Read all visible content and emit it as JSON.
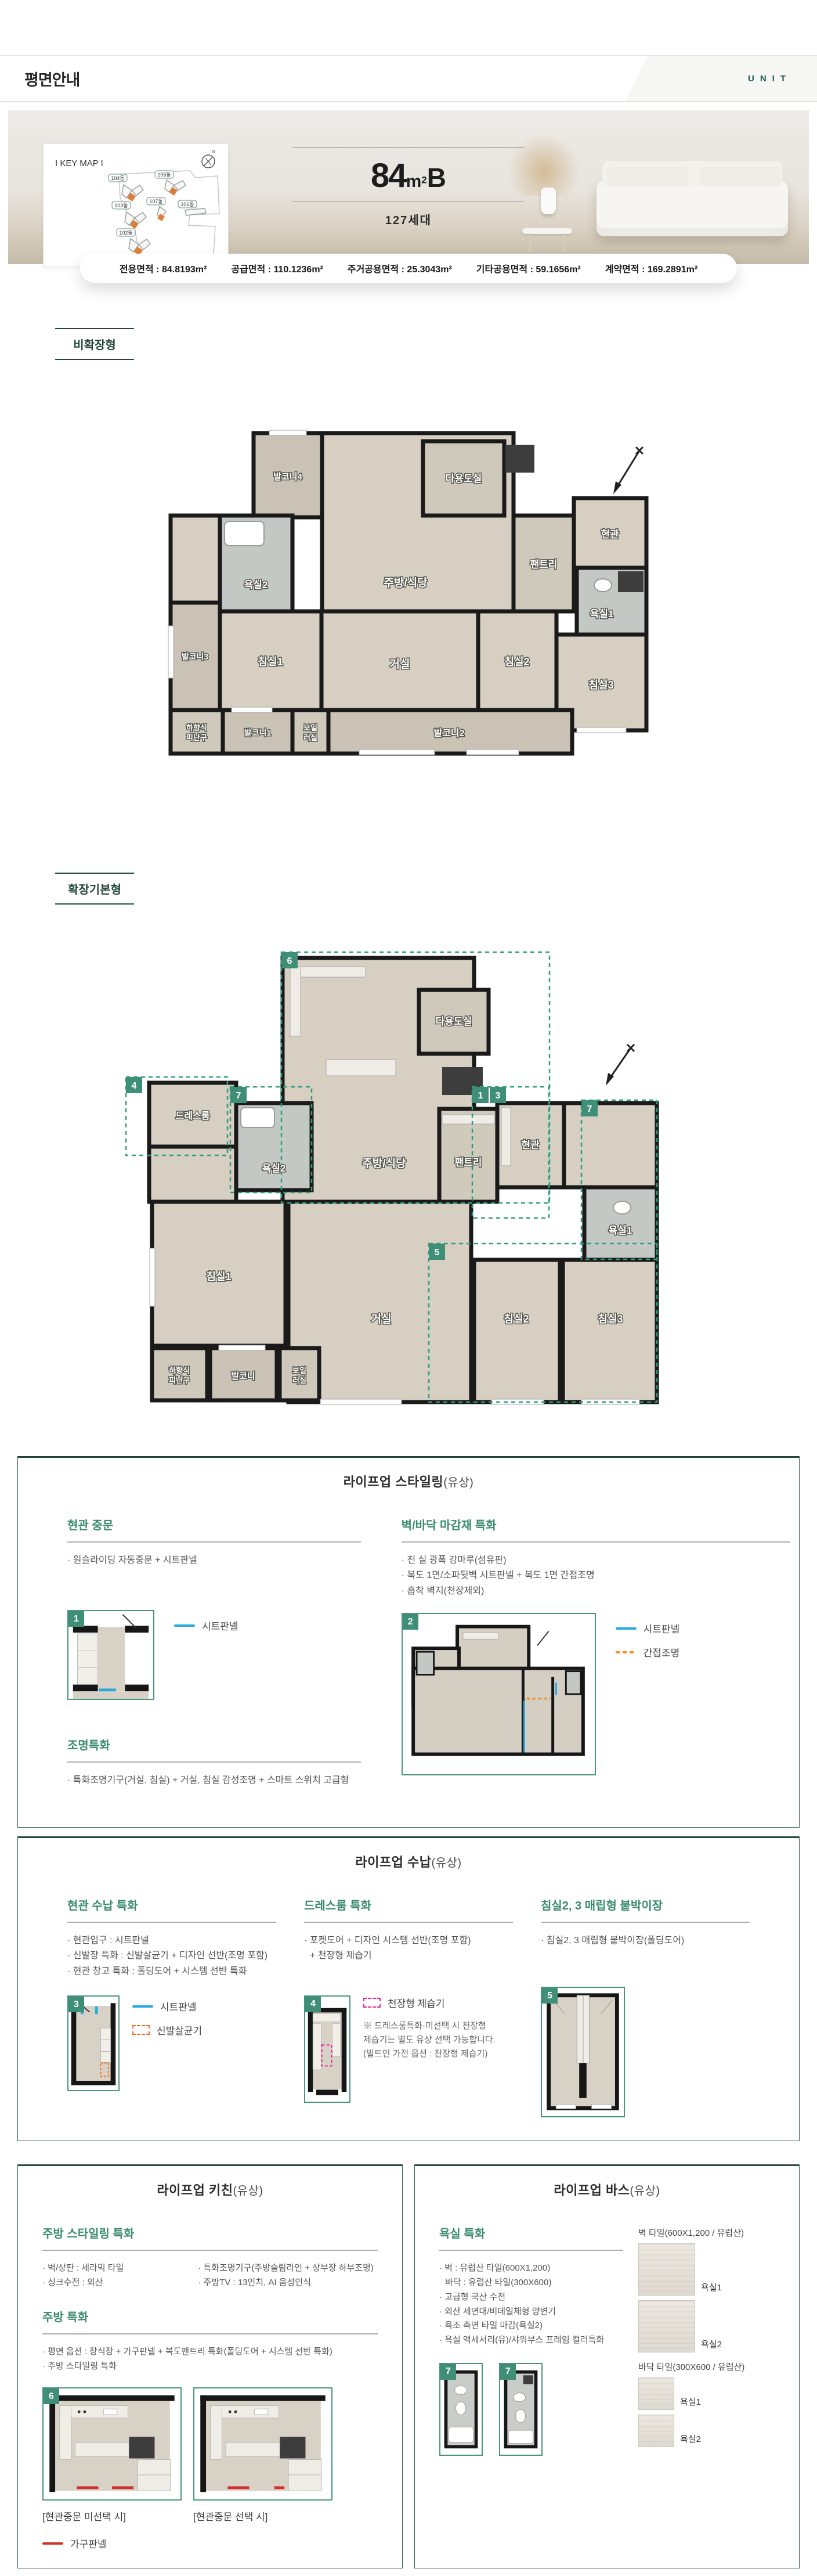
{
  "colors": {
    "accent_green": "#3a8a71",
    "dark_green": "#25473d",
    "teal": "#17574c",
    "legend_blue": "#2aa9e0",
    "legend_orange": "#ed6b21",
    "legend_indirect_orange": "#f0932c",
    "legend_magenta": "#ec1f8e",
    "legend_red": "#d0312d",
    "keymap_highlight_orange": "#dd7f3c"
  },
  "header": {
    "title": "평면안내",
    "unit": "UNIT"
  },
  "hero": {
    "keymap_title": "I KEY MAP I",
    "north": "N",
    "buildings": [
      "104동",
      "105동",
      "103동",
      "107동",
      "106동",
      "102동",
      "101동"
    ],
    "area_num": "84",
    "area_unit_m": "m",
    "area_unit_sup": "2",
    "area_type": "B",
    "households": "127세대"
  },
  "area_bar": [
    {
      "label": "전용면적 :",
      "value": "84.8193m²"
    },
    {
      "label": "공급면적 :",
      "value": "110.1236m²"
    },
    {
      "label": "주거공용면적 :",
      "value": "25.3043m²"
    },
    {
      "label": "기타공용면적 :",
      "value": "59.1656m²"
    },
    {
      "label": "계약면적 :",
      "value": "169.2891m²"
    }
  ],
  "plan1": {
    "tag": "비확장형",
    "rooms": {
      "balcony4": "발코니4",
      "utility": "다용도실",
      "kitchen": "주방/식당",
      "pantry": "팬트리",
      "entrance": "현관",
      "bath2": "욕실2",
      "bath1": "욕실1",
      "balcony3": "발코니3",
      "bed1": "침실1",
      "living": "거실",
      "bed2": "침실2",
      "bed3": "침실3",
      "escape1": "하향식",
      "escape2": "피난구",
      "balcony1": "발코니1",
      "boiler1": "보일",
      "boiler2": "러실",
      "balcony2": "발코니2"
    }
  },
  "plan2": {
    "tag": "확장기본형",
    "rooms": {
      "utility": "다용도실",
      "kitchen": "주방/식당",
      "pantry": "팬트리",
      "entrance": "현관",
      "dress": "드레스룸",
      "bath2": "욕실2",
      "bath1": "욕실1",
      "bed1": "침실1",
      "living": "거실",
      "bed2": "침실2",
      "bed3": "침실3",
      "escape1": "하향식",
      "escape2": "피난구",
      "balcony": "발코니",
      "boiler1": "보일",
      "boiler2": "러실"
    },
    "badges": {
      "b6": "6",
      "b4": "4",
      "b7l": "7",
      "b1": "1",
      "b3": "3",
      "b7r": "7",
      "b5": "5"
    }
  },
  "styling": {
    "title": "라이프업 스타일링",
    "fee": "(유상)",
    "door_h": "현관 중문",
    "door_b": "· 원슬라이딩 자동중문 + 시트판넬",
    "door_badge": "1",
    "door_legend": "시트판넬",
    "light_h": "조명특화",
    "light_b": "· 특화조명기구(거실, 침실) + 거실, 침실 감성조명 + 스마트 스위치 고급형",
    "wall_h": "벽/바닥 마감재 특화",
    "wall_b1": "· 전 실 광폭 강마루(섬유판)",
    "wall_b2": "· 복도 1면/소파뒷벽 시트판넬 + 복도 1면 간접조명",
    "wall_b3": "· 흡착 벽지(천장제외)",
    "wall_badge": "2",
    "wall_legend1": "시트판넬",
    "wall_legend2": "간접조명"
  },
  "storage": {
    "title": "라이프업 수납",
    "fee": "(유상)",
    "c1_h": "현관 수납 특화",
    "c1_b1": "· 현관입구 : 시트판넬",
    "c1_b2": "· 신발장 특화 : 신발살균기 + 디자인 선반(조명 포함)",
    "c1_b3": "· 현관 창고 특화 : 폴딩도어 + 시스템 선반 특화",
    "c1_badge": "3",
    "c1_leg1": "시트판넬",
    "c1_leg2": "신발살균기",
    "c2_h": "드레스룸 특화",
    "c2_b1": "· 포켓도어 + 디자인 시스템 선반(조명 포함)",
    "c2_b2": "+ 천장형 제습기",
    "c2_badge": "4",
    "c2_leg": "천장형 제습기",
    "c2_n1": "※ 드레스룸특화·미선택 시 천장형",
    "c2_n2": "제습기는 별도 유상 선택 가능합니다.",
    "c2_n3": "(빌트인 가전 옵션 : 천장형 제습기)",
    "c3_h": "침실2, 3 매립형 붙박이장",
    "c3_b1": "· 침실2, 3 매립형 붙박이장(폴딩도어)",
    "c3_badge": "5"
  },
  "kitchen": {
    "title": "라이프업 키친",
    "fee": "(유상)",
    "h1": "주방 스타일링 특화",
    "b1a1": "· 벽/상판 : 세라믹 타일",
    "b1a2": "· 싱크수전 : 외산",
    "b1b1": "· 특화조명기구(주방슬림라인 + 상부장 하부조명)",
    "b1b2": "· 주방TV : 13인치, AI 음성인식",
    "h2": "주방 특화",
    "b2a": "· 평면 옵션 : 장식장 + 가구판넬 + 복도팬트리 특화(폴딩도어 + 시스템 선반 특화)",
    "b2b": "· 주방 스타일링 특화",
    "badge": "6",
    "cap1": "[현관중문 미선택 시]",
    "cap2": "[현관중문 선택 시]",
    "legend": "가구판넬"
  },
  "bath": {
    "title": "라이프업 바스",
    "fee": "(유상)",
    "h": "욕실 특화",
    "b1": "· 벽 : 유럽산 타일(600X1,200)",
    "b2": "바닥 : 유럽산 타일(300X600)",
    "b3": "· 고급형 국산 수전",
    "b4": "· 외산 세면대/비데일체형 양변기",
    "b5": "· 욕조 측면 타일 마감(욕실2)",
    "b6": "· 욕실 액세서리(유)/샤워부스 프레임 컬러특화",
    "wall_cap": "벽 타일(600X1,200 / 유럽산)",
    "floor_cap": "바닥 타일(300X600 / 유럽산)",
    "t1": "욕실1",
    "t2": "욕실2",
    "t3": "욕실1",
    "t4": "욕실2",
    "badge1": "7",
    "badge2": "7"
  }
}
